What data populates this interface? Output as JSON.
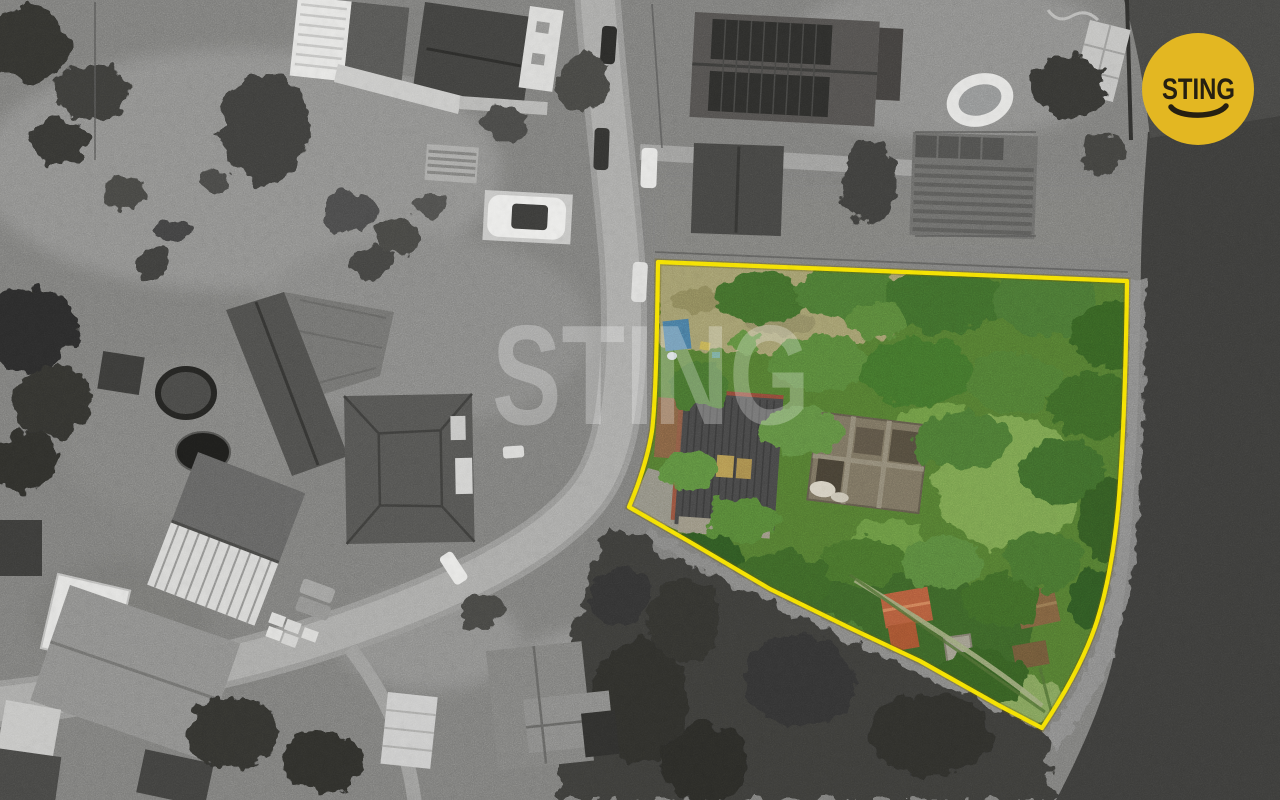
{
  "image": {
    "kind": "aerial-drone-photo",
    "description": "Black-and-white aerial view of a village street with houses, barns and gardens; one irregular building plot on the right is shown in full colour (overgrown garden, derelict buildings) and outlined in yellow, bordered by a dark water/field area."
  },
  "watermark": {
    "text": "STING",
    "color": "#ffffff",
    "opacity": "0.27"
  },
  "brand_badge": {
    "text": "STING",
    "shape": "circle",
    "bg_color": "#e3b722",
    "fg_color": "#262011",
    "icon": "smile-icon"
  },
  "parcel": {
    "boundary_color": "#f8e303",
    "boundary_style": "solid",
    "highlight": "full colour parcel against grayscale surroundings"
  },
  "palette": {
    "canopy_green": "#47702e",
    "lawn_green": "#7aa350",
    "dry_grass": "#9f996b",
    "ruin_roof_gray": "#454545",
    "red_roof": "#b15a3a",
    "road_gray": "#a6a6a4",
    "water_dark": "#3b3b39"
  }
}
